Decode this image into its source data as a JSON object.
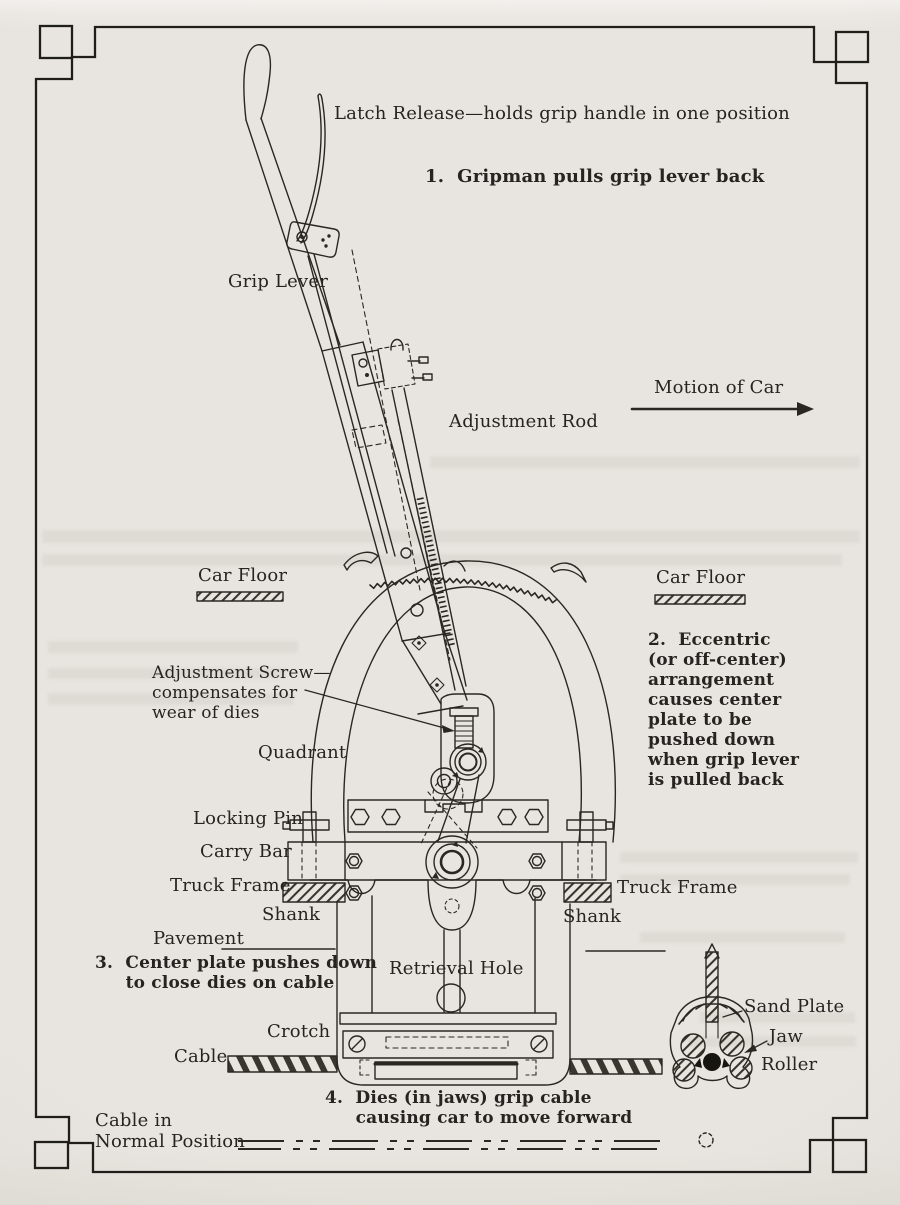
{
  "colors": {
    "paper": "#e8e5e0",
    "ink": "#2a2722",
    "border": "#1e1c18"
  },
  "labels": {
    "latch_release": "Latch Release—holds grip handle in one position",
    "step1": "1.  Gripman pulls grip lever back",
    "grip_lever": "Grip Lever",
    "motion_of_car": "Motion of Car",
    "adjustment_rod": "Adjustment Rod",
    "car_floor_left": "Car Floor",
    "car_floor_right": "Car Floor",
    "step2": "2.  Eccentric\n(or off-center)\narrangement\ncauses center\nplate to be\npushed down\nwhen grip lever\nis pulled back",
    "adjustment_screw": "Adjustment Screw—\ncompensates for\nwear of dies",
    "quadrant": "Quadrant",
    "locking_pin": "Locking Pin",
    "carry_bar": "Carry Bar",
    "truck_frame_left": "Truck Frame",
    "truck_frame_right": "Truck Frame",
    "shank_left": "Shank",
    "shank_right": "Shank",
    "pavement": "Pavement",
    "step3": "3.  Center plate pushes down\n     to close dies on cable",
    "retrieval_hole": "Retrieval Hole",
    "crotch": "Crotch",
    "cable": "Cable",
    "step4": "4.  Dies (in jaws) grip cable\n     causing car to move forward",
    "sand_plate": "Sand Plate",
    "jaw": "Jaw",
    "roller": "Roller",
    "cable_in_normal_position": "Cable in\nNormal Position"
  }
}
